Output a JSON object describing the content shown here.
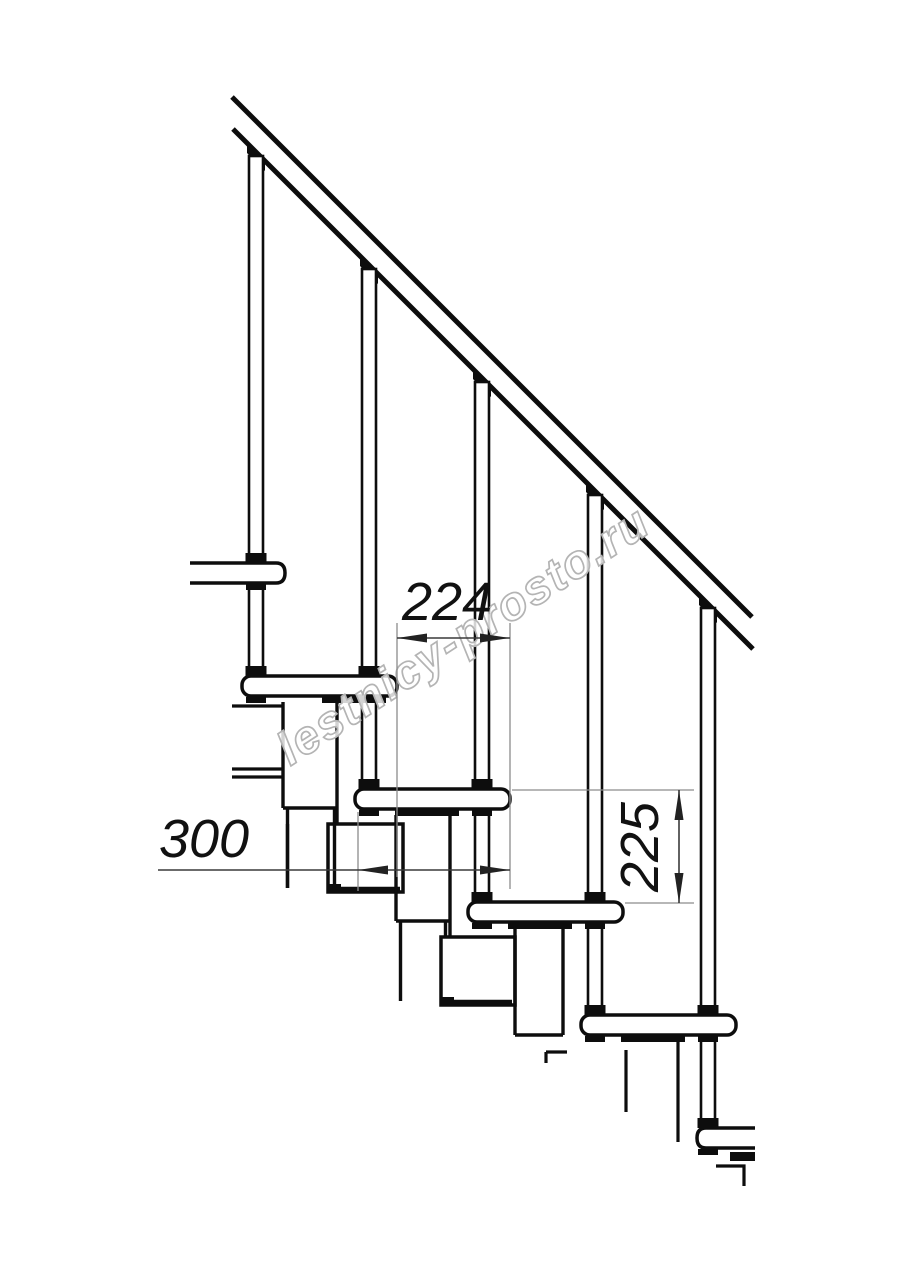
{
  "drawing": {
    "watermark": "lestnicy-prosto.ru",
    "dimensions": {
      "step_run": "224",
      "tread_depth": "300",
      "step_rise": "225"
    },
    "colors": {
      "line": "#0d0d0d",
      "dimension_line": "#3a3a3a",
      "extension_line": "#8c8c8c",
      "watermark_outline": "#b4b4b4",
      "background": "#ffffff"
    }
  }
}
